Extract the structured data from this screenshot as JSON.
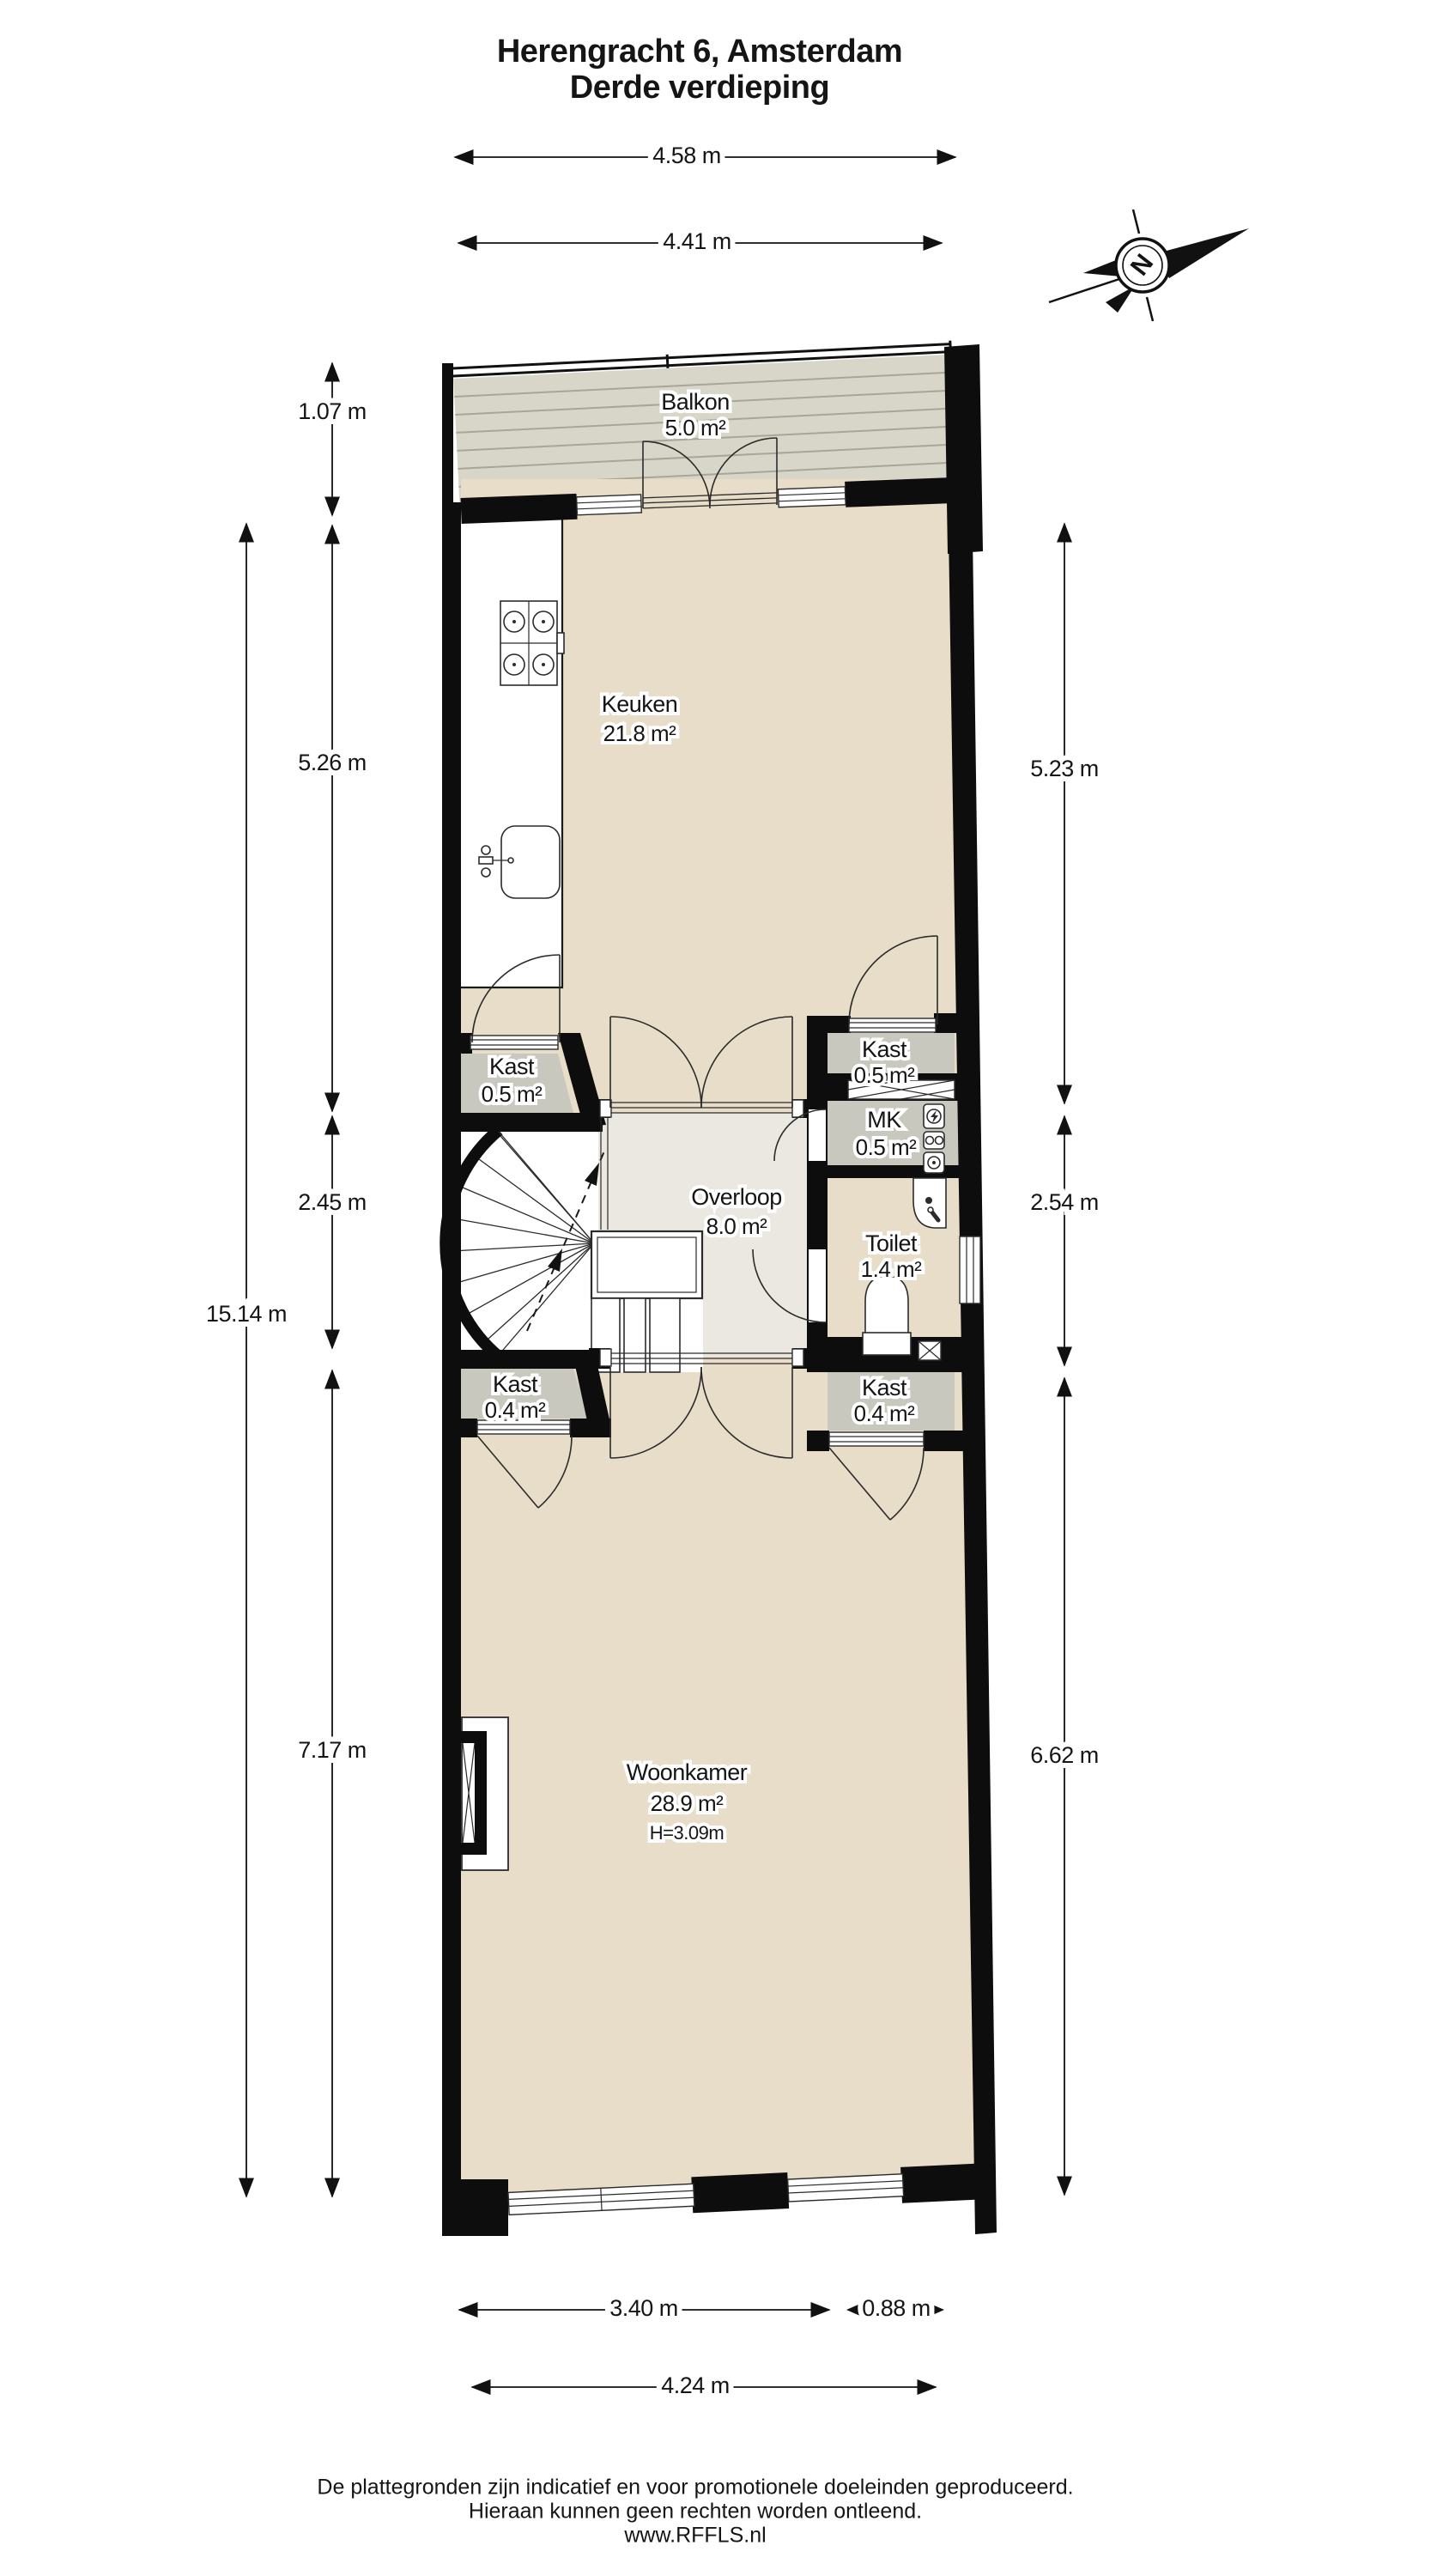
{
  "header": {
    "title_line1": "Herengracht 6, Amsterdam",
    "title_line2": "Derde verdieping"
  },
  "compass": {
    "north_label": "N"
  },
  "rooms": {
    "balkon": {
      "name": "Balkon",
      "area": "5.0 m²"
    },
    "keuken": {
      "name": "Keuken",
      "area": "21.8 m²"
    },
    "kast_boven_links": {
      "name": "Kast",
      "area": "0.5 m²"
    },
    "kast_boven_rechts": {
      "name": "Kast",
      "area": "0.5 m²"
    },
    "mk": {
      "name": "MK",
      "area": "0.5 m²"
    },
    "overloop": {
      "name": "Overloop",
      "area": "8.0 m²"
    },
    "toilet": {
      "name": "Toilet",
      "area": "1.4 m²"
    },
    "kast_onder_links": {
      "name": "Kast",
      "area": "0.4 m²"
    },
    "kast_onder_rechts": {
      "name": "Kast",
      "area": "0.4 m²"
    },
    "woonkamer": {
      "name": "Woonkamer",
      "area": "28.9 m²",
      "ceiling_height": "H=3.09m"
    }
  },
  "dimensions": {
    "top": [
      "4.58 m",
      "4.41 m"
    ],
    "left": [
      "1.07 m",
      "5.26 m",
      "2.45 m",
      "7.17 m",
      "15.14 m"
    ],
    "right": [
      "5.23 m",
      "2.54 m",
      "6.62 m"
    ],
    "bottom": [
      "3.40 m",
      "0.88 m",
      "4.24 m"
    ]
  },
  "footer": {
    "line1": "De plattegronden zijn indicatief en voor promotionele doeleinden geproduceerd.",
    "line2": "Hieraan kunnen geen rechten worden ontleend.",
    "line3": "www.RFFLS.nl"
  },
  "colors": {
    "wall": "#0d0d0d",
    "floor_beige": "#e8ddc8",
    "floor_grey": "#c9c8bf",
    "floor_overloop": "#eae8e0",
    "balcony": "#d8d6c8",
    "deck_line": "#a8a699"
  }
}
